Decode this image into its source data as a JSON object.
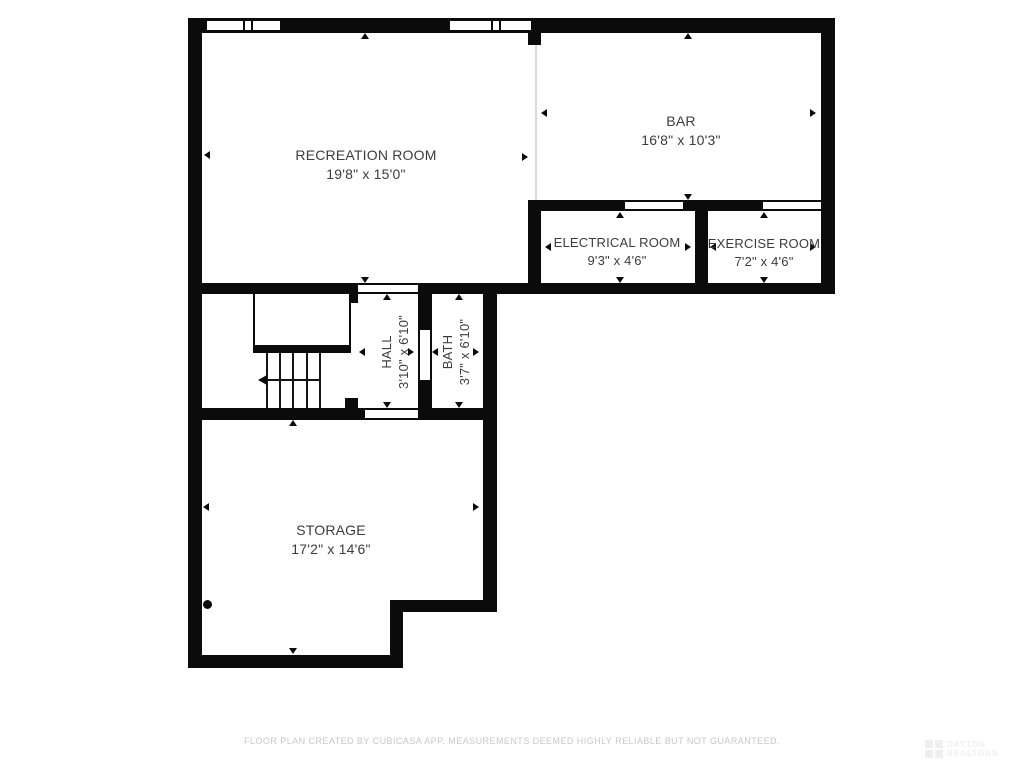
{
  "floor_plan": {
    "rooms": [
      {
        "name": "RECREATION ROOM",
        "dims": "19'8\" x 15'0\""
      },
      {
        "name": "BAR",
        "dims": "16'8\" x 10'3\""
      },
      {
        "name": "ELECTRICAL ROOM",
        "dims": "9'3\" x 4'6\""
      },
      {
        "name": "EXERCISE ROOM",
        "dims": "7'2\" x 4'6\""
      },
      {
        "name": "HALL",
        "dims": "3'10\" x 6'10\""
      },
      {
        "name": "BATH",
        "dims": "3'7\" x 6'10\""
      },
      {
        "name": "STORAGE",
        "dims": "17'2\" x 14'6\""
      }
    ],
    "footer": "FLOOR PLAN CREATED BY CUBICASA APP. MEASUREMENTS DEEMED HIGHLY RELIABLE BUT NOT GUARANTEED.",
    "watermark": {
      "line1": "DAYTON",
      "line2": "REALTORS"
    },
    "colors": {
      "wall": "#0b0b0b",
      "background": "#ffffff",
      "label_text": "#3c3c3c",
      "footer_text": "#c8c8c8"
    }
  }
}
